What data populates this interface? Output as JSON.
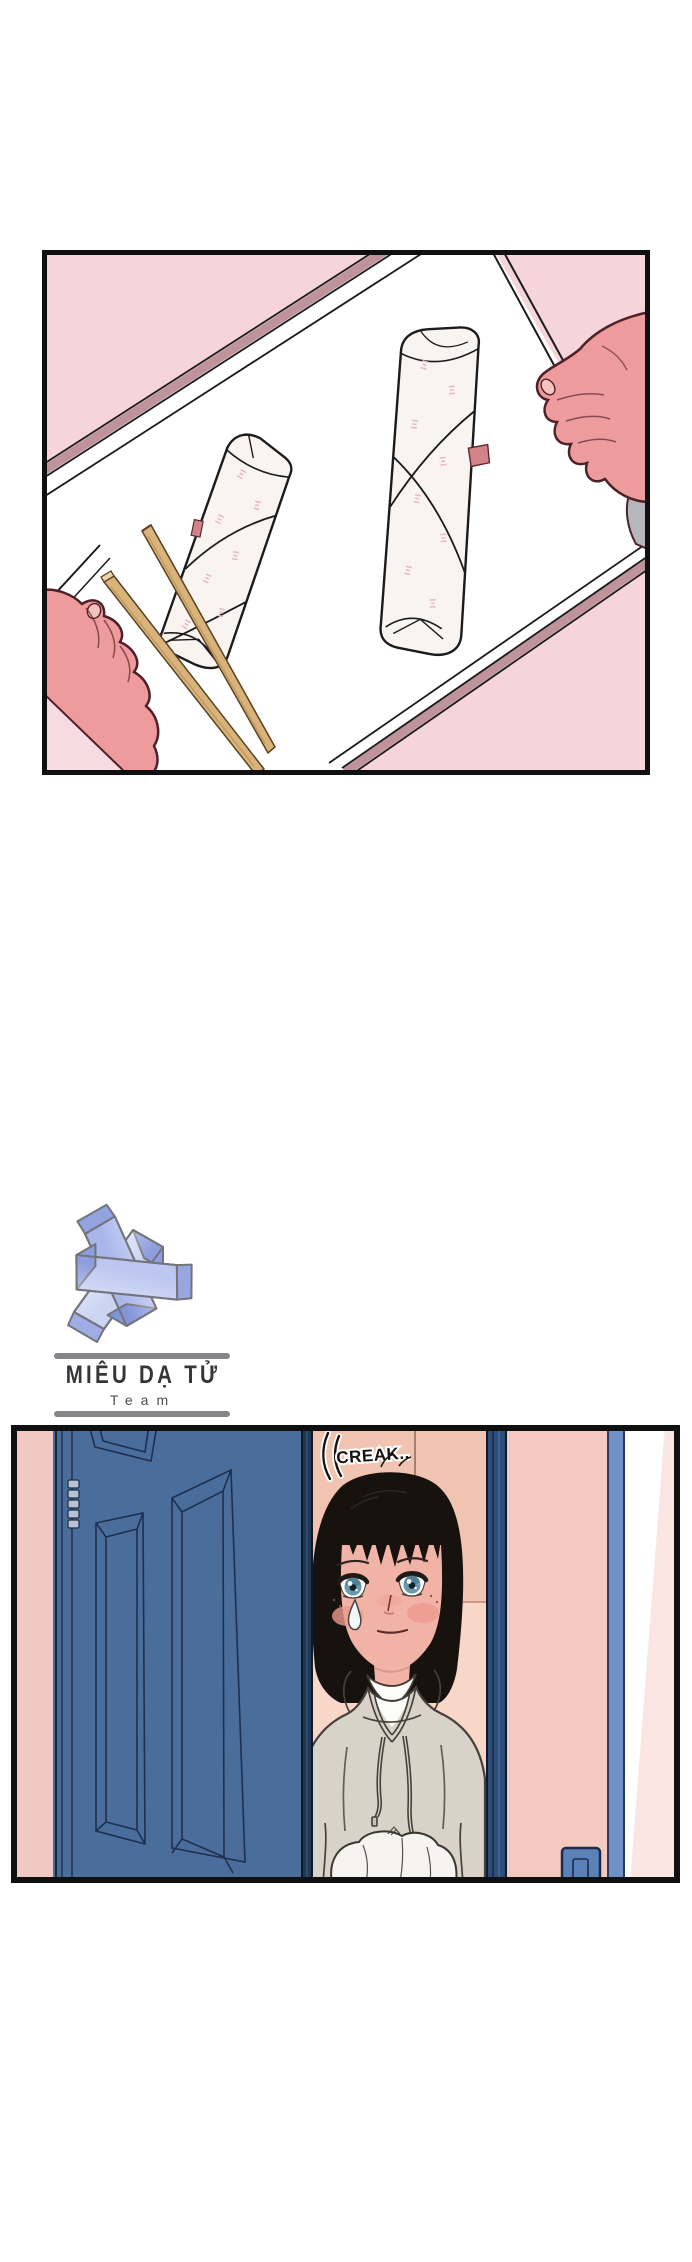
{
  "page": {
    "width": 692,
    "height": 2262,
    "background": "#ffffff"
  },
  "panel1": {
    "colors": {
      "background_pink": "#f5d4da",
      "tray_white": "#ffffff",
      "rim_mauve": "#bf939a",
      "roll_paper": "#faf4f1",
      "roll_text_pink": "#e4bcc6",
      "seal_tab": "#d2838a",
      "chopstick_tan": "#d9b37c",
      "skin_pink": "#ee9b9d",
      "outline_dark": "#4d2127",
      "sleeve_grey": "#b6b7bc",
      "sleeve_pale": "#f6dce2"
    }
  },
  "logo": {
    "title": "MIÊU DẠ TỬ",
    "subtitle": "Team",
    "bar_color": "#85868a",
    "lavender_light": "#ccd4f3",
    "lavender_mid": "#a9b6ea",
    "lavender_deep": "#8d9ddd",
    "outline_grey": "#73757d"
  },
  "panel2": {
    "sfx": "CREAK..",
    "colors": {
      "door_blue": "#4a6d9c",
      "door_line": "#1e3050",
      "door_edge_navy": "#22364f",
      "wall_pink_left": "#f2c8c2",
      "wall_peach_upper": "#f1c3b1",
      "wall_peach_lower": "#f8d7c9",
      "wall_pink_right": "#f3c9c0",
      "frame_navy": "#2e4d78",
      "frame_blue_band": "#6e90c4",
      "highlight_pale_pink": "#fae5e3",
      "hair_black": "#17120e",
      "skin": "#f2b3a7",
      "blush": "#ec9a90",
      "iris_teal": "#6b98ab",
      "hoodie_grey": "#d8d2c8",
      "tee_white": "#fcfcfa",
      "bundle_white": "#f6f4f0",
      "switch_blue": "#5b82b8"
    }
  }
}
